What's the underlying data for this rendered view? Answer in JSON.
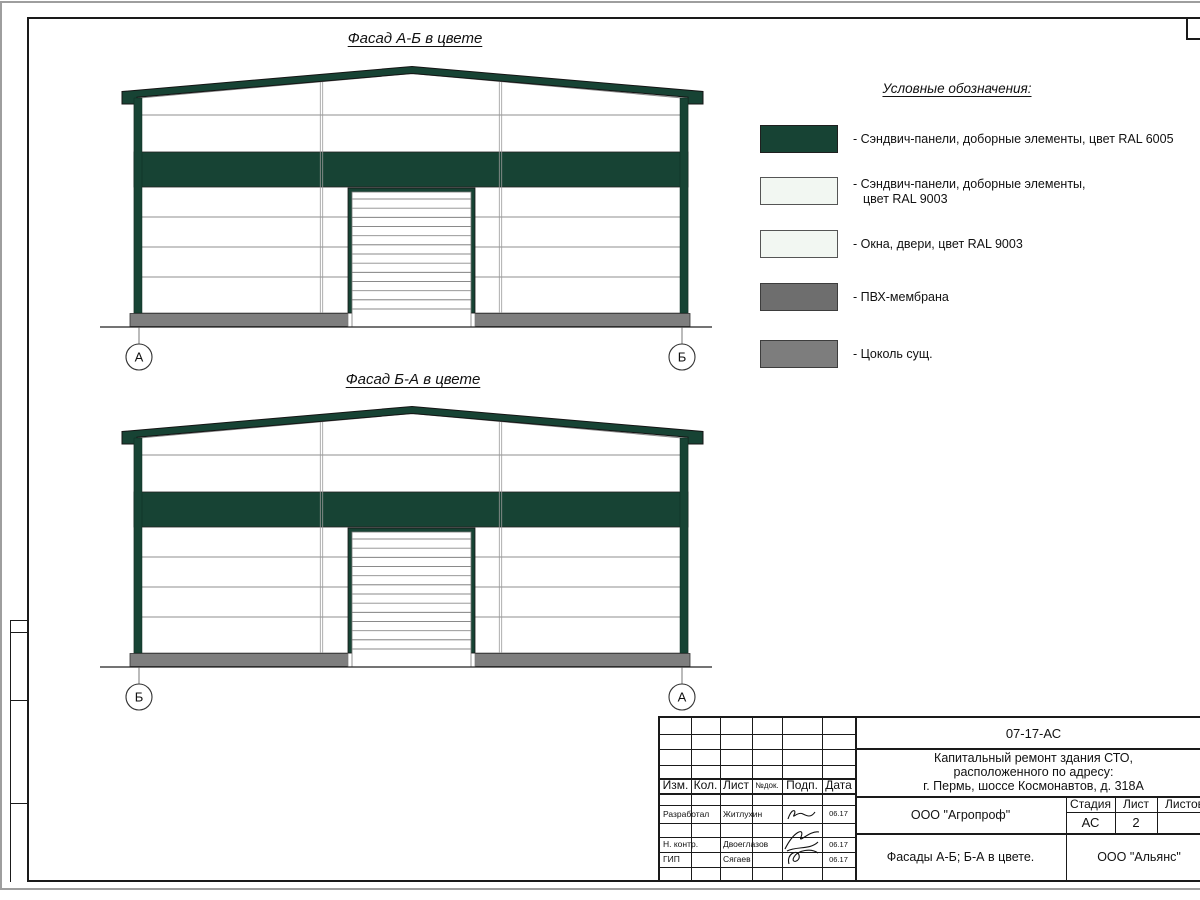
{
  "facades": [
    {
      "title": "Фасад А-Б в цвете",
      "axis_left": "А",
      "axis_right": "Б"
    },
    {
      "title": "Фасад Б-А в цвете",
      "axis_left": "Б",
      "axis_right": "А"
    }
  ],
  "legend": {
    "title": "Условные обозначения:",
    "items": [
      {
        "name": "sandwich-panels-ral6005",
        "color": "#174334",
        "line1": "- Сэндвич-панели, доборные элементы,  цвет RAL 6005",
        "line2": ""
      },
      {
        "name": "sandwich-panels-ral9003",
        "color": "#F2F7F2",
        "line1": "- Сэндвич-панели, доборные элементы,",
        "line2": "цвет RAL 9003"
      },
      {
        "name": "windows-doors-ral9003",
        "color": "#F2F7F2",
        "line1": "- Окна, двери, цвет RAL 9003",
        "line2": ""
      },
      {
        "name": "pvc-membrane",
        "color": "#6E6E6E",
        "line1": "- ПВХ-мембрана",
        "line2": ""
      },
      {
        "name": "existing-basement",
        "color": "#7D7D7D",
        "line1": "- Цоколь сущ.",
        "line2": ""
      }
    ]
  },
  "title_block": {
    "doc_number": "07-17-АС",
    "project_line1": "Капитальный ремонт здания СТО,",
    "project_line2": "расположенного по адресу:",
    "project_line3": "г. Пермь, шоссе Космонавтов, д. 318А",
    "col_izm": "Изм.",
    "col_kol": "Кол.",
    "col_list": "Лист",
    "col_ndoc": "№док.",
    "col_podp": "Подп.",
    "col_data": "Дата",
    "rows": [
      {
        "role": "Разработал",
        "name": "Житлухин",
        "date": "06.17"
      },
      {
        "role": "Н. контр.",
        "name": "Двоеглазов",
        "date": "06.17"
      },
      {
        "role": "ГИП",
        "name": "Сягаев",
        "date": "06.17"
      }
    ],
    "customer": "ООО \"Агропроф\"",
    "stage_label": "Стадия",
    "sheet_label": "Лист",
    "sheets_label": "Листов",
    "stage": "АС",
    "sheet": "2",
    "sheet_title": "Фасады А-Б; Б-А в цвете.",
    "org": "ООО \"Альянс\""
  },
  "colors": {
    "ral6005_green": "#174334",
    "ral9003_white": "#F2F7F2",
    "membrane_gray": "#6E6E6E",
    "basement_gray": "#7D7D7D",
    "plinth_gray": "#7E7E7E"
  }
}
